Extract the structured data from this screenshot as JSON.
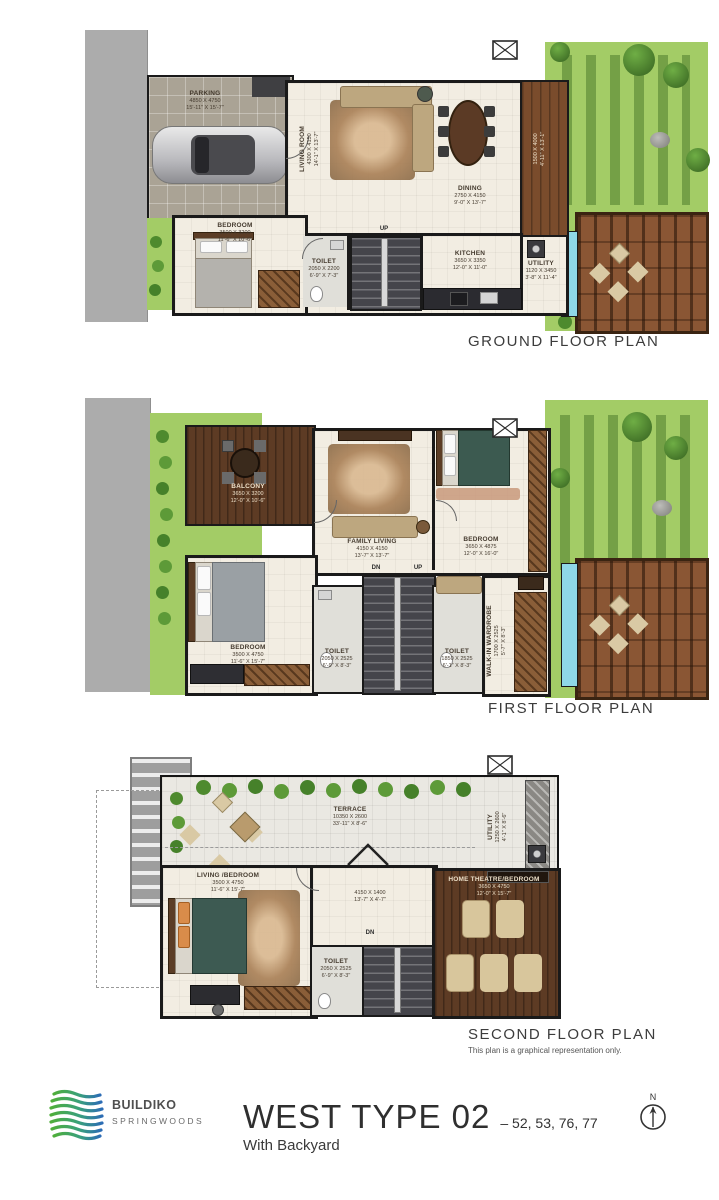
{
  "branding": {
    "logo_title": "BUILDIKO",
    "logo_subtitle": "SPRINGWOODS",
    "plan_title": "WEST TYPE 02",
    "plan_units": "– 52, 53, 76, 77",
    "plan_subtitle": "With Backyard",
    "north_label": "N"
  },
  "disclaimer": "This plan is a graphical representation only.",
  "colors": {
    "wall": "#1a1a1a",
    "floor_cream": "#f2ede2",
    "lawn_green": "#a3cc66",
    "deck_wood": "#7a4c2c",
    "water_blue": "#8fd8e8",
    "logo_green": "#4fae3a",
    "logo_blue": "#2c6cb5"
  },
  "floors": [
    {
      "title": "GROUND FLOOR PLAN",
      "stair_labels": {
        "up": "UP"
      },
      "rooms": [
        {
          "name": "PARKING",
          "metric": "4850 X 4750",
          "imperial": "15'-11\" X 15'-7\""
        },
        {
          "name": "LIVING ROOM",
          "metric": "4300 X 4150",
          "imperial": "14'-1\" X 13'-7\""
        },
        {
          "name": "DINING",
          "metric": "2750 X 4150",
          "imperial": "9'-0\" X 13'-7\""
        },
        {
          "name": "KITCHEN",
          "metric": "3650 X 3350",
          "imperial": "12'-0\" X 11'-0\""
        },
        {
          "name": "BEDROOM",
          "metric": "3500 X 3200",
          "imperial": "11'-6\" X 10'-6\""
        },
        {
          "name": "TOILET",
          "metric": "2050 X 2200",
          "imperial": "6'-9\" X 7'-3\""
        },
        {
          "name": "UTILITY",
          "metric": "1120 X 3450",
          "imperial": "3'-8\" X 11'-4\""
        },
        {
          "name": "",
          "metric": "1500 X 4000",
          "imperial": "4'-11\" X 13'-1\""
        }
      ]
    },
    {
      "title": "FIRST FLOOR PLAN",
      "stair_labels": {
        "dn": "DN",
        "up": "UP"
      },
      "rooms": [
        {
          "name": "BALCONY",
          "metric": "3650 X 3200",
          "imperial": "12'-0\" X 10'-6\""
        },
        {
          "name": "FAMILY LIVING",
          "metric": "4150 X 4150",
          "imperial": "13'-7\" X 13'-7\""
        },
        {
          "name": "BEDROOM",
          "metric": "3650 X 4875",
          "imperial": "12'-0\" X 16'-0\""
        },
        {
          "name": "BEDROOM",
          "metric": "3500 X 4750",
          "imperial": "11'-6\" X 15'-7\""
        },
        {
          "name": "TOILET",
          "metric": "2050 X 2525",
          "imperial": "6'-9\" X 8'-3\""
        },
        {
          "name": "TOILET",
          "metric": "1850 X 2525",
          "imperial": "6'-1\" X 8'-3\""
        },
        {
          "name": "WALK-IN WARDROBE",
          "metric": "1700 X 2525",
          "imperial": "5'-7\" X 8'-3\""
        }
      ]
    },
    {
      "title": "SECOND FLOOR PLAN",
      "stair_labels": {
        "dn": "DN"
      },
      "rooms": [
        {
          "name": "TERRACE",
          "metric": "10350 X 2600",
          "imperial": "33'-11\" X 8'-6\""
        },
        {
          "name": "UTILITY",
          "metric": "1250 X 2600",
          "imperial": "4'-1\" X 8'-6\""
        },
        {
          "name": "LIVING /BEDROOM",
          "metric": "3500 X 4750",
          "imperial": "11'-6\" X 15'-7\""
        },
        {
          "name": "",
          "metric": "4150 X 1400",
          "imperial": "13'-7\" X 4'-7\""
        },
        {
          "name": "HOME THEATRE/BEDROOM",
          "metric": "3650 X 4750",
          "imperial": "12'-0\" X 15'-7\""
        },
        {
          "name": "TOILET",
          "metric": "2050 X 2525",
          "imperial": "6'-9\" X 8'-3\""
        }
      ]
    }
  ]
}
